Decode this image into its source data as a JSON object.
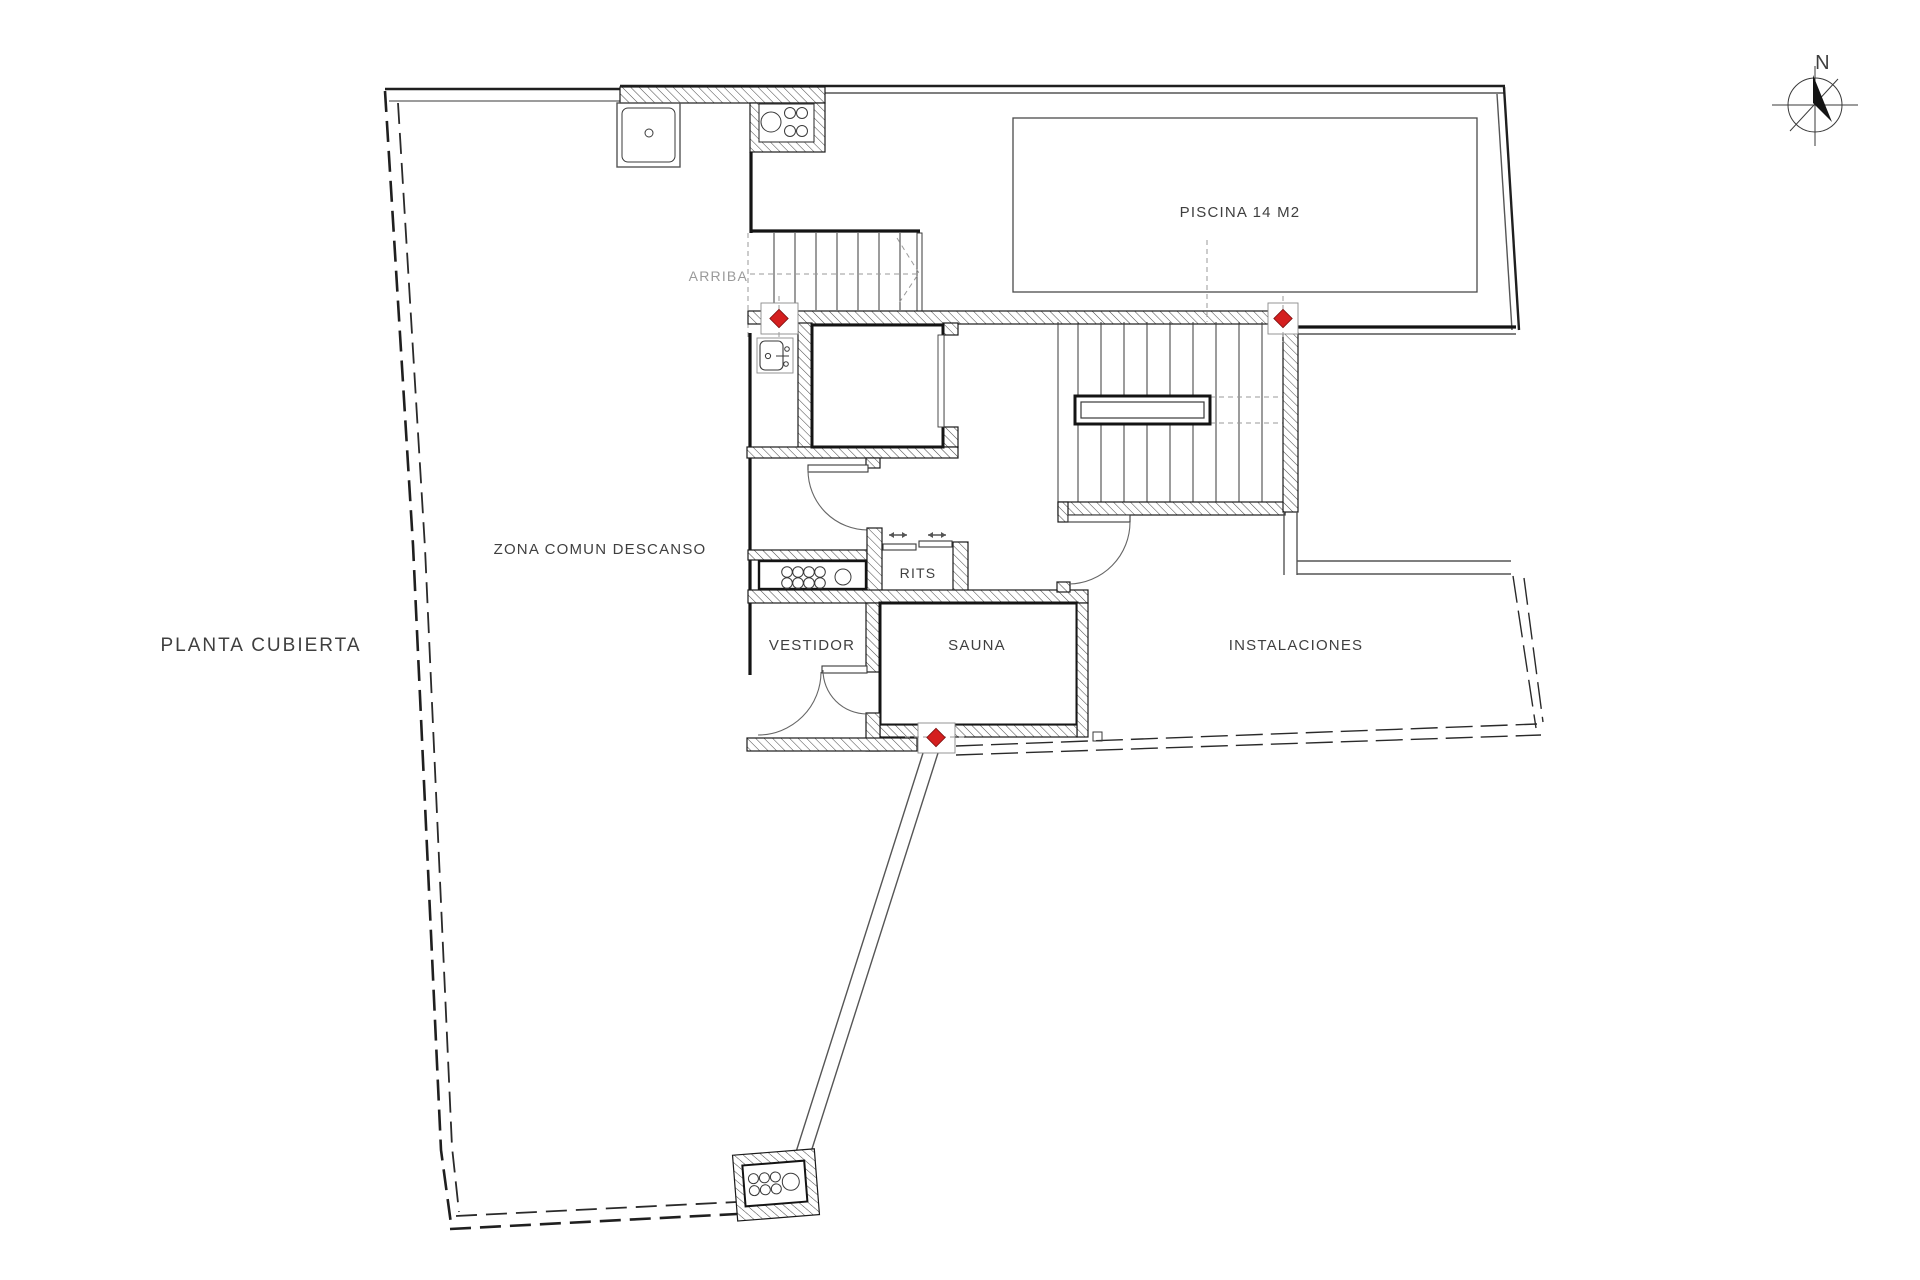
{
  "plan": {
    "title": "PLANTA CUBIERTA",
    "areas": {
      "zona_comun": "ZONA COMUN DESCANSO",
      "piscina": "PISCINA 14 M2",
      "rits": "RITS",
      "vestidor": "VESTIDOR",
      "sauna": "SAUNA",
      "instalaciones": "INSTALACIONES"
    },
    "stair_label": "ARRIBA",
    "compass_north": "N"
  },
  "colors": {
    "background": "#ffffff",
    "line": "#1f1f1f",
    "hatch": "#4a4a4a",
    "marker_red": "#d41f1f",
    "text": "#3f3f3f",
    "muted_text": "#9a9a9a"
  },
  "markers": {
    "red_diamond_count": 3
  }
}
